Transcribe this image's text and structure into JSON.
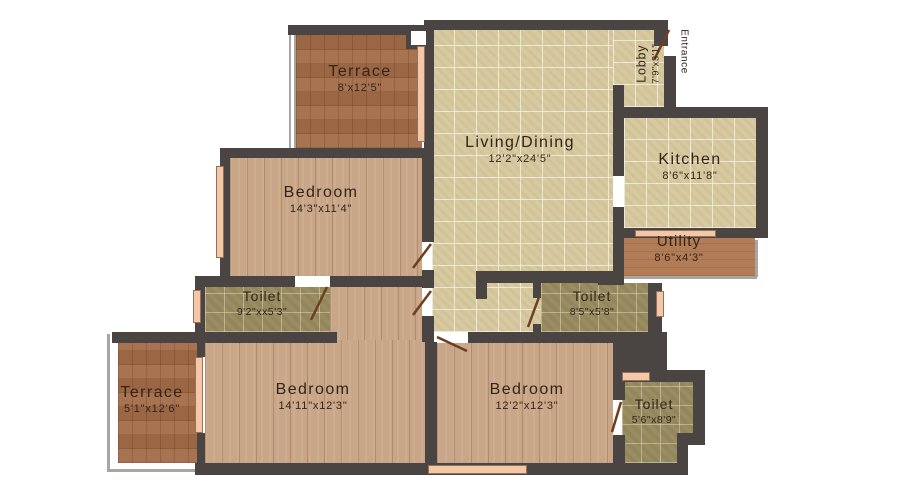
{
  "plan": {
    "title": "Apartment floor plan",
    "entrance_label": "Entrance",
    "rooms": [
      {
        "id": "terrace-top",
        "name": "Terrace",
        "dims": "8'x12'5\""
      },
      {
        "id": "living-dining",
        "name": "Living/Dining",
        "dims": "12'2\"x24'5\""
      },
      {
        "id": "lobby",
        "name": "Lobby",
        "dims": "7'9\"x3'1\""
      },
      {
        "id": "kitchen",
        "name": "Kitchen",
        "dims": "8'6\"x11'8\""
      },
      {
        "id": "utility",
        "name": "Utility",
        "dims": "8'6\"x4'3\""
      },
      {
        "id": "bedroom-top",
        "name": "Bedroom",
        "dims": "14'3\"x11'4\""
      },
      {
        "id": "toilet-left",
        "name": "Toilet",
        "dims": "9'2\"xx5'3\""
      },
      {
        "id": "toilet-middle",
        "name": "Toilet",
        "dims": "8'5\"x5'8\""
      },
      {
        "id": "terrace-bottom",
        "name": "Terrace",
        "dims": "5'1\"x12'6\""
      },
      {
        "id": "bedroom-bottom-left",
        "name": "Bedroom",
        "dims": "14'11\"x12'3\""
      },
      {
        "id": "bedroom-bottom-right",
        "name": "Bedroom",
        "dims": "12'2\"x12'3\""
      },
      {
        "id": "toilet-bottom-right",
        "name": "Toilet",
        "dims": "5'6\"x8'9\""
      }
    ],
    "colors": {
      "wall": "#4a4442",
      "tile_floor": "#d7c9a0",
      "wood_floor": "#c9a687",
      "parquet_floor": "#a26c48",
      "toilet_floor": "#9b8d62",
      "utility_floor": "#b27c57",
      "window": "#f4c7a6",
      "door_swing": "#6e3f1f",
      "label_text": "#33241a",
      "background": "#ffffff"
    }
  }
}
